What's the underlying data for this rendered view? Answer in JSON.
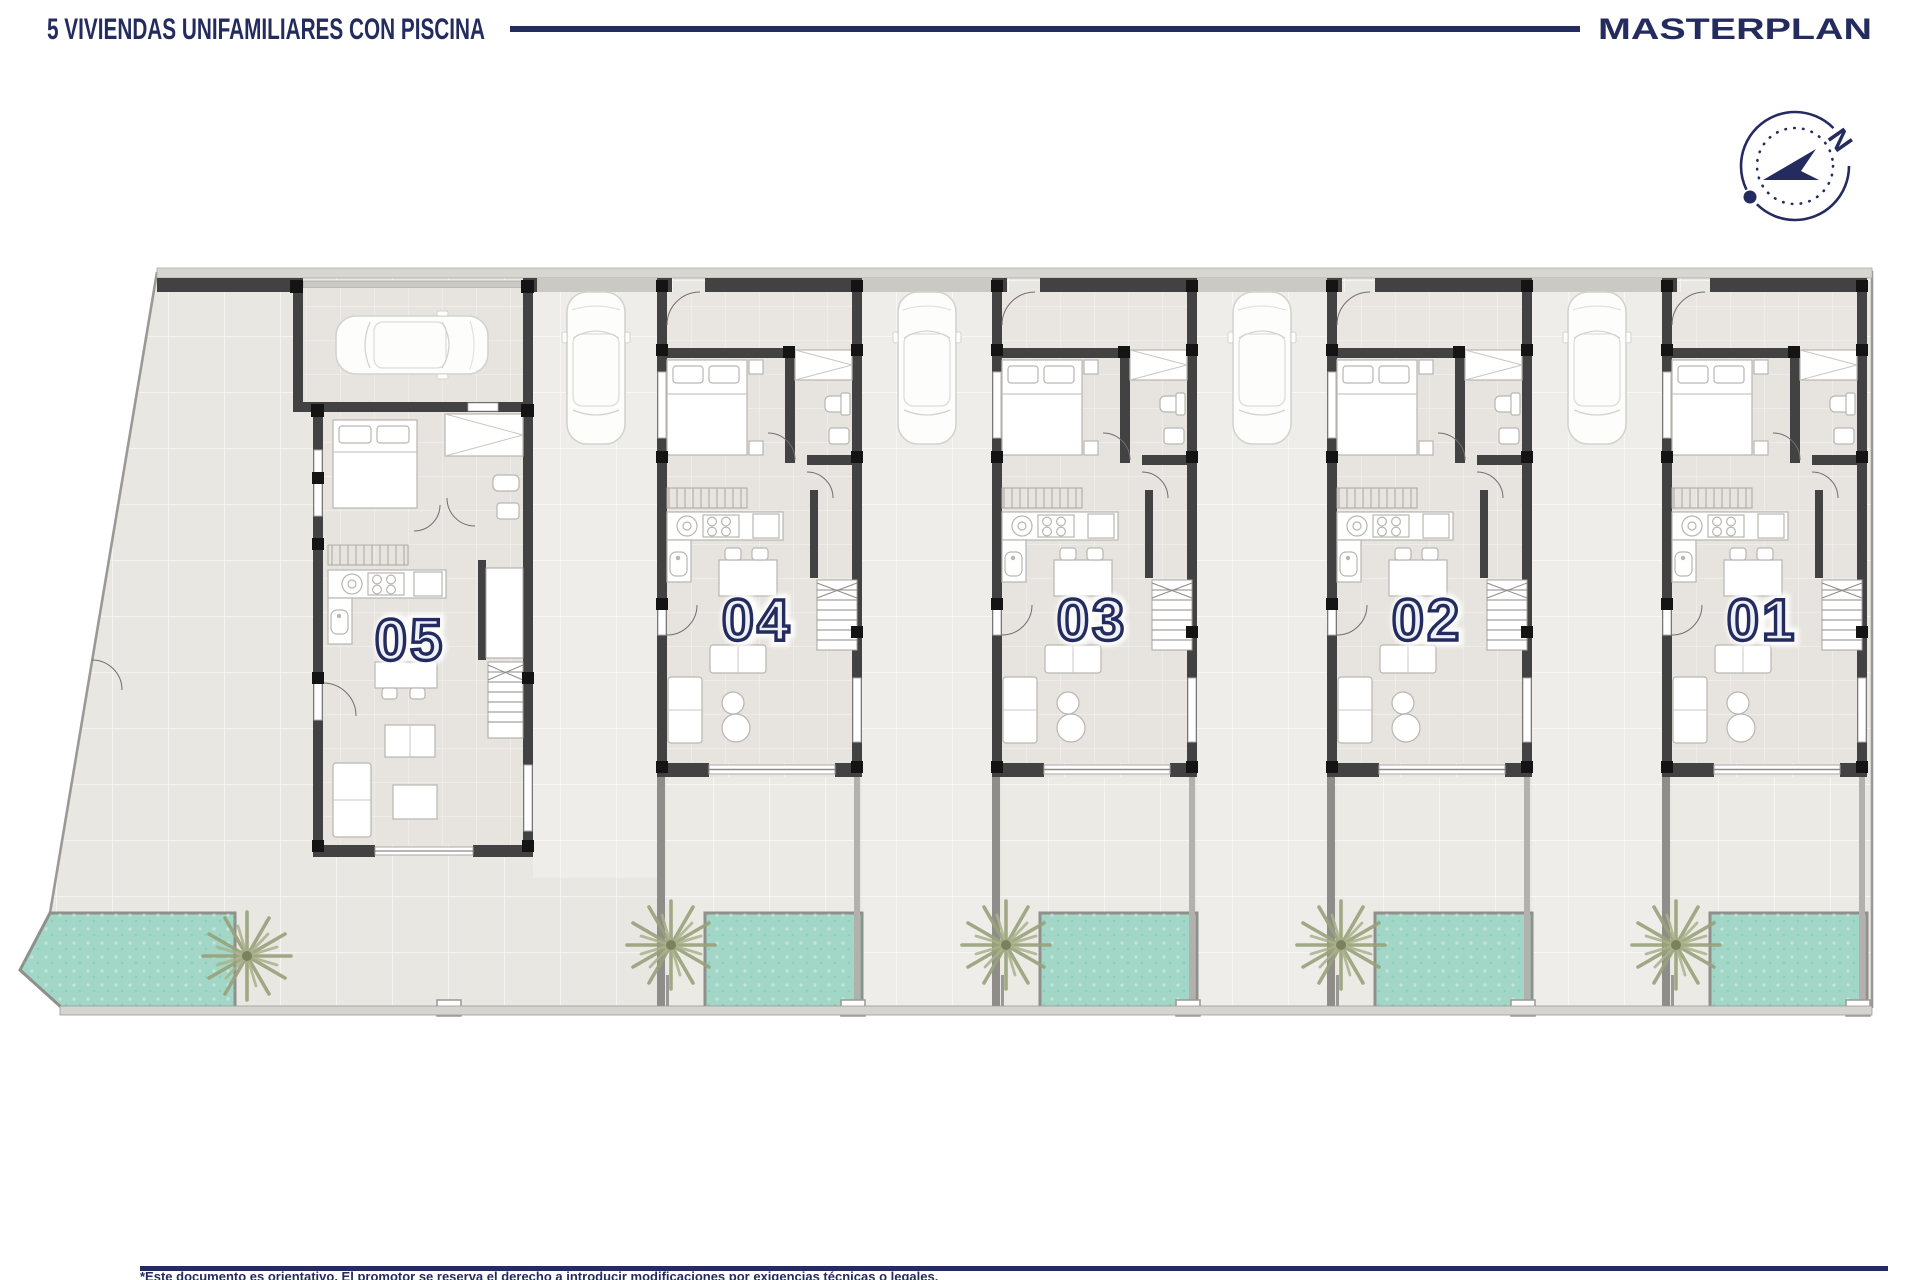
{
  "header": {
    "title": "5 VIVIENDAS UNIFAMILIARES CON PISCINA",
    "plan_label": "MASTERPLAN"
  },
  "compass": {
    "north_label": "N"
  },
  "plan": {
    "units": [
      {
        "number": "05"
      },
      {
        "number": "04"
      },
      {
        "number": "03"
      },
      {
        "number": "02"
      },
      {
        "number": "01"
      }
    ]
  },
  "footer": {
    "disclaimer": "*Este documento es orientativo. El promotor se reserva el derecho a introducir modificaciones por exigencias técnicas o legales."
  },
  "colors": {
    "navy": "#242b5e",
    "pool": "#a2d7c8",
    "wall": "#424242",
    "floor": "#e7e4df",
    "terrace": "#eceae5",
    "palm": "#99a17a"
  }
}
